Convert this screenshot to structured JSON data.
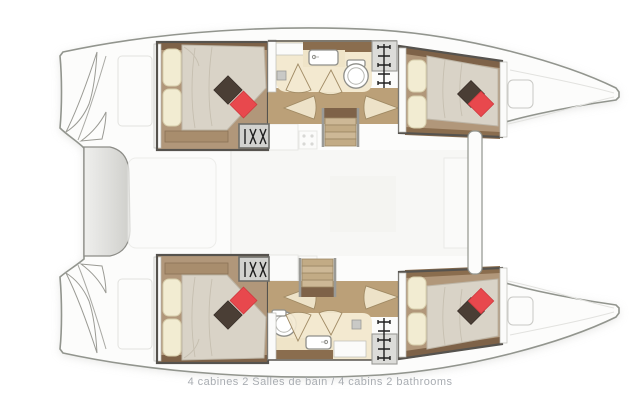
{
  "caption": {
    "text": "4 cabines 2 Salles de bain / 4 cabins 2 bathrooms"
  },
  "palette": {
    "background": "#ffffff",
    "caption_color": "#a9adb2",
    "hull_fill": "#fcfcfb",
    "hull_stroke": "#92958e",
    "shadow": "#d0d0cd",
    "wall": "#56534e",
    "wood_floor": "#b1977a",
    "wood_dark": "#7e6248",
    "wood_mid": "#8a6d4e",
    "corridor_wood": "#bba078",
    "stair_tread": "#cdb896",
    "mattress": "#d9d3c7",
    "mattress_line": "#c6bfb0",
    "pillow_cream": "#f2ecd2",
    "pillow_cream_edge": "#d8cfad",
    "pillow_red": "#e8484d",
    "pillow_dark": "#4a3e35",
    "bath_floor": "#f3e9d0",
    "fixture_stroke": "#8f8f8a",
    "hatch_fill": "#d2d2cf",
    "hatch_stroke": "#6e6e69",
    "glyph": "#1f1f1f"
  },
  "icons": {
    "companionway_steps": "diagonal-steps-glyph",
    "escape_ladder": "rung-ladder-glyph",
    "toilet": "round-bowl-glyph",
    "washbasin": "rounded-rect-with-faucet",
    "door_swing": "quarter-circle-fan",
    "stove": "four-burner-dots"
  }
}
